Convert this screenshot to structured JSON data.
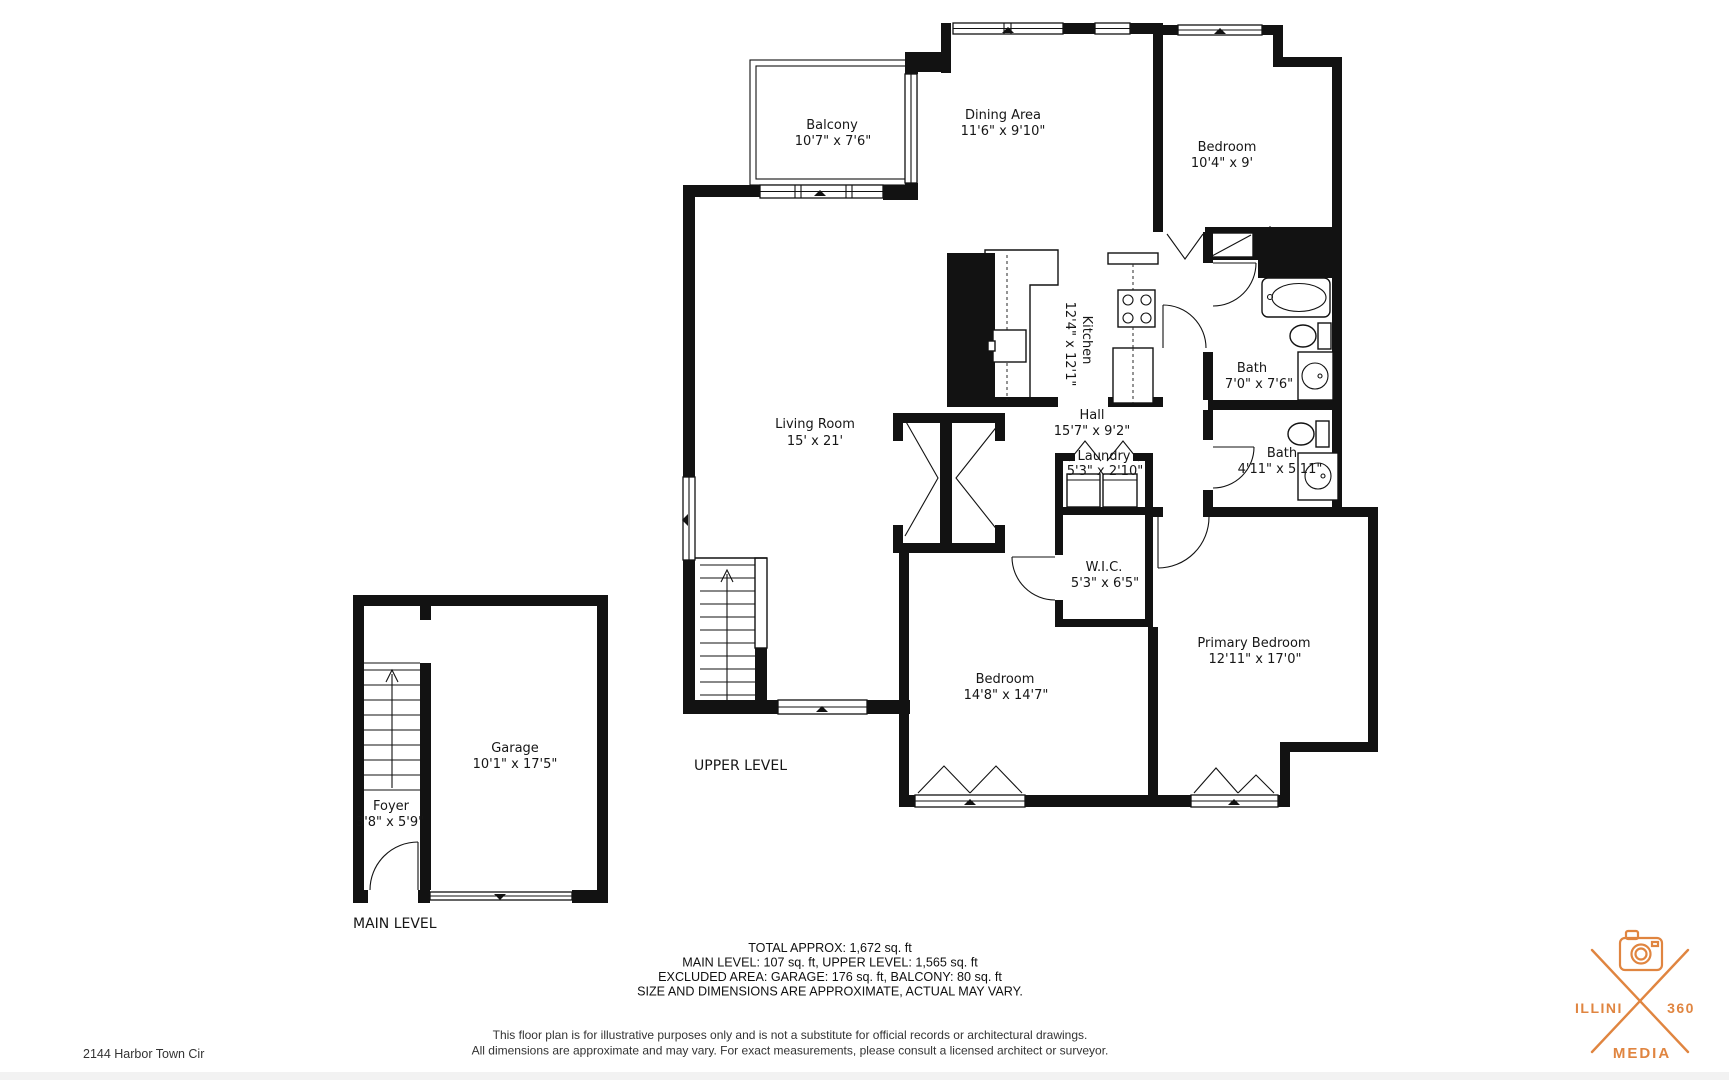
{
  "plan": {
    "upper_level_label": "UPPER LEVEL",
    "main_level_label": "MAIN LEVEL",
    "rooms": {
      "balcony": {
        "name": "Balcony",
        "dims": "10'7\" x 7'6\""
      },
      "dining": {
        "name": "Dining Area",
        "dims": "11'6\" x 9'10\""
      },
      "bedroom_top": {
        "name": "Bedroom",
        "dims": "10'4\" x 9'"
      },
      "kitchen": {
        "name": "Kitchen",
        "dims": "12'4\" x 12'1\""
      },
      "bath_main": {
        "name": "Bath",
        "dims": "7'0\" x 7'6\""
      },
      "living": {
        "name": "Living Room",
        "dims": "15' x 21'"
      },
      "hall": {
        "name": "Hall",
        "dims": "15'7\" x 9'2\""
      },
      "laundry": {
        "name": "Laundry",
        "dims": "5'3\" x 2'10\""
      },
      "bath_small": {
        "name": "Bath",
        "dims": "4'11\" x 5'11\""
      },
      "wic": {
        "name": "W.I.C.",
        "dims": "5'3\" x 6'5\""
      },
      "bedroom_mid": {
        "name": "Bedroom",
        "dims": "14'8\" x 14'7\""
      },
      "primary": {
        "name": "Primary Bedroom",
        "dims": "12'11\" x 17'0\""
      },
      "garage": {
        "name": "Garage",
        "dims": "10'1\" x 17'5\""
      },
      "foyer": {
        "name": "Foyer",
        "dims": "3'8\" x 5'9\""
      }
    }
  },
  "summary": {
    "line1": "TOTAL APPROX: 1,672 sq. ft",
    "line2": "MAIN LEVEL: 107 sq. ft, UPPER LEVEL: 1,565 sq. ft",
    "line3": "EXCLUDED AREA: GARAGE: 176 sq. ft, BALCONY: 80 sq. ft",
    "line4": "SIZE AND DIMENSIONS ARE APPROXIMATE, ACTUAL MAY VARY."
  },
  "disclaimer": {
    "line1": "This floor plan is for illustrative purposes only and is not a substitute for official records or architectural drawings.",
    "line2": "All dimensions are approximate and may vary. For exact measurements, please consult a licensed architect or surveyor."
  },
  "address": "2144 Harbor Town Cir",
  "logo": {
    "left": "ILLINI",
    "right": "360",
    "bottom": "MEDIA"
  },
  "colors": {
    "wall": "#121212",
    "accent": "#E08540"
  }
}
